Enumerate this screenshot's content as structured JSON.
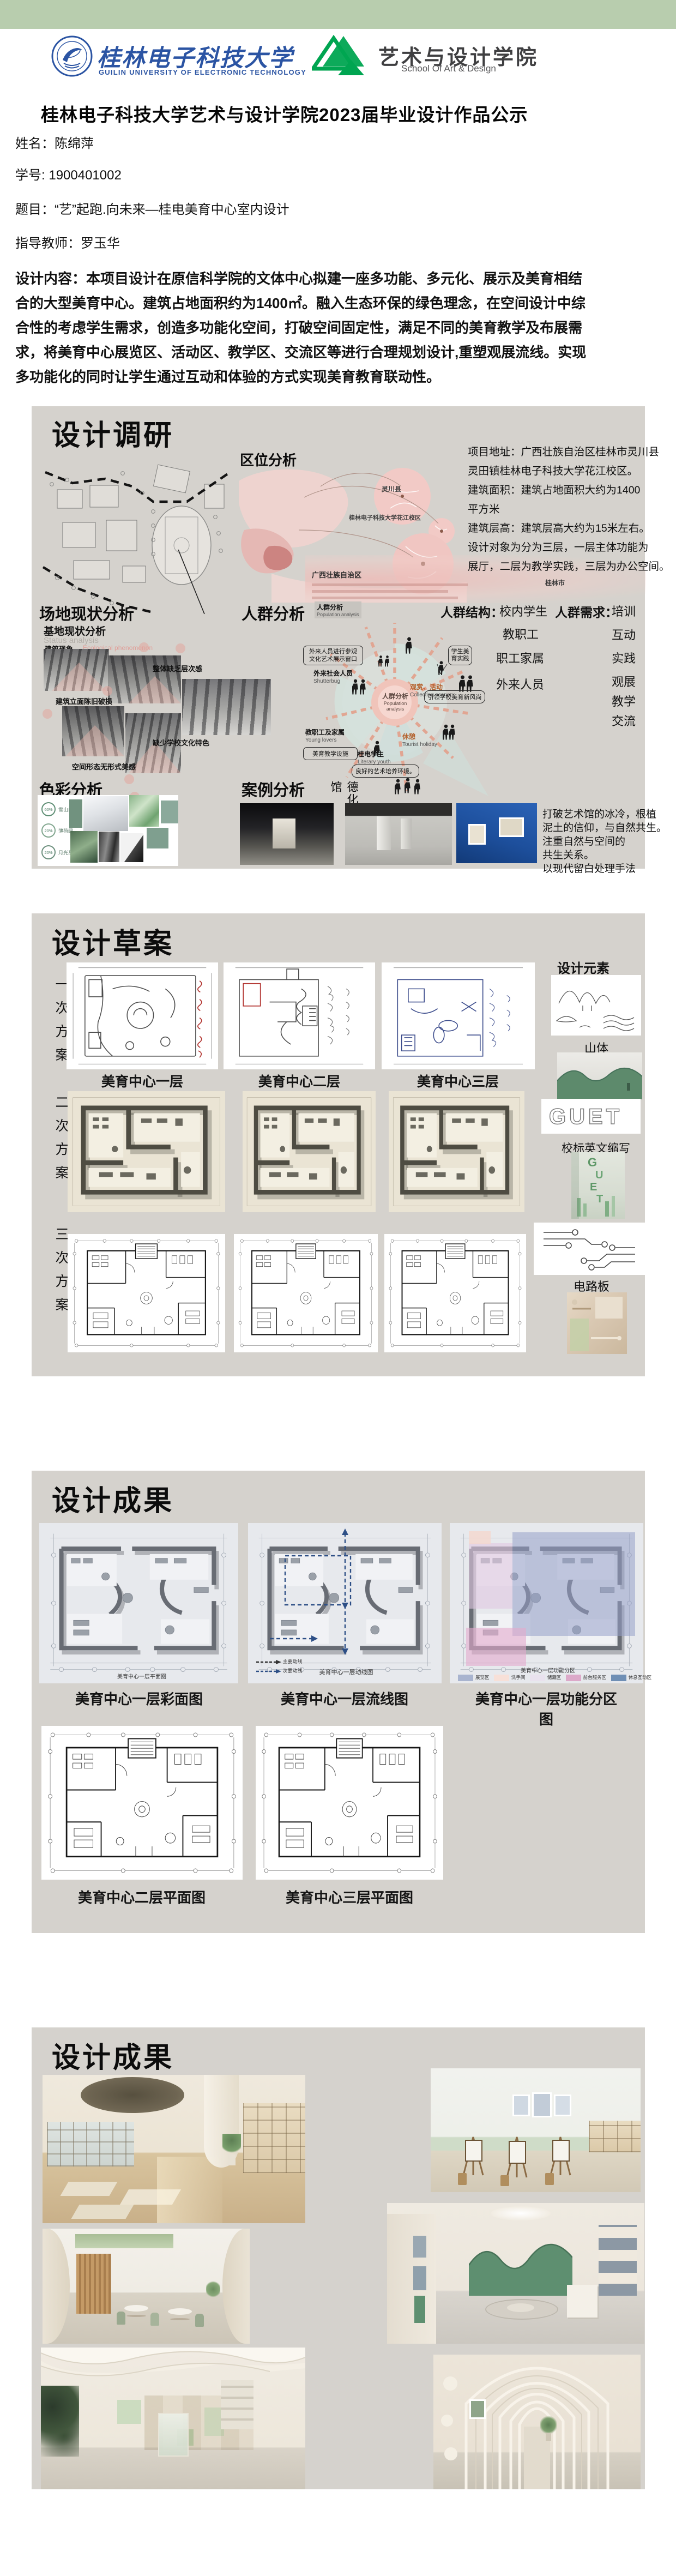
{
  "colors": {
    "top_bar_green": "#b8cdae",
    "panel_gray": "#d5d2cd",
    "guet_blue": "#2b54a3",
    "art_green": "#00a551",
    "map_pink": "#eecfcb",
    "ray_salmon": "#e2a38f",
    "sage_green": "#7f9f8f"
  },
  "header": {
    "guet_logo": {
      "zh": "桂林电子科技大学",
      "en": "GUILIN UNIVERSITY OF ELECTRONIC TECHNOLOGY"
    },
    "art_logo": {
      "zh": "艺术与设计学院",
      "en": "School Of Art & Design"
    }
  },
  "title": "桂林电子科技大学艺术与设计学院2023届毕业设计作品公示",
  "info": {
    "name_label": "姓名：",
    "name": "陈绵萍",
    "sid_label": "学号: ",
    "sid": "1900401002",
    "topic_label": "题目：",
    "topic": "“艺”起跑.向未来—桂电美育中心室内设计",
    "advisor_label": "指导教师：",
    "advisor": "罗玉华",
    "content_lines": [
      "设计内容：本项目设计在原信科学院的文体中心拟建一座多功能、多元化、展示及美育相结",
      "合的大型美育中心。建筑占地面积约为1400㎡。融入生态环保的绿色理念，在空间设计中综",
      "合性的考虑学生需求，创造多功能化空间，打破空间固定性，满足不同的美育教学及布展需",
      "求，将美育中心展览区、活动区、教学区、交流区等进行合理规划设计,重塑观展流线。实现",
      "多功能化的同时让学生通过互动和体验的方式实现美育教育联动性。"
    ]
  },
  "research": {
    "title": "设计调研",
    "location": {
      "heading": "区位分析",
      "labels": {
        "lingchuan": "灵川县",
        "campus": "桂林电子科技大学花江校区",
        "guilin": "桂林市",
        "guangxi": "广西壮族自治区"
      },
      "lines": [
        "项目地址：广西壮族自治区桂林市灵川县",
        "灵田镇桂林电子科技大学花江校区。",
        "建筑面积：建筑占地面积大约为1400",
        "平方米",
        "建筑层高：建筑层高大约为15米左右。",
        "设计对象为分为三层，一层主体功能为",
        "展厅，二层为教学实践，三层为办公空间。"
      ]
    },
    "site": {
      "heading": "场地现状分析",
      "sub": "基地现状分析",
      "sub_en": "Status analysis",
      "tag": "建筑现象",
      "tag_en": "Ecological phenomenon",
      "labels": [
        "整体缺乏层次感",
        "建筑立面陈旧破损",
        "缺少学校文化特色",
        "空间形态无形式美感"
      ]
    },
    "population": {
      "heading": "人群分析",
      "caption_zh": "人群分析",
      "caption_en": "Population analysis",
      "center_zh": "人群分析",
      "center_en1": "Population",
      "center_en2": "analysis",
      "bubbles": {
        "b1": "学生美育实践",
        "b2": "引领学校美育新风尚",
        "b3": "良好的艺术培养环境。",
        "b4": "美育教学设施",
        "b5a": "外来人员进行参观",
        "b5b": "文化艺术展示窗口"
      },
      "nodes": {
        "n1": "观赏、活动",
        "n1_en": "Collecting scenery",
        "n2": "休憩",
        "n2_en": "Tourist holiday",
        "n3": "桂电学生",
        "n3_en": "Literary youth",
        "n4": "教职工及家属",
        "n4_en": "Young lovers",
        "n5": "外来社会人员",
        "n5_en": "Shutterbug"
      },
      "structure_label": "人群结构：",
      "structure": [
        "校内学生",
        "教职工",
        "职工家属",
        "外来人员"
      ],
      "needs_label": "人群需求：",
      "needs": [
        "培训",
        "互动",
        "实践",
        "观展",
        "教学",
        "交流"
      ]
    },
    "color": {
      "heading": "色彩分析",
      "swatches": [
        {
          "pct": "60%",
          "name": "雪山白"
        },
        {
          "pct": "20%",
          "name": "薄荷绿"
        },
        {
          "pct": "20%",
          "name": "月光灰"
        }
      ]
    },
    "case": {
      "heading": "案例分析",
      "name": "德化龙鹏艺术馆",
      "desc": [
        "打破艺术馆的冰冷，根植",
        "泥土的信仰，与自然共生。",
        "注重自然与空间的",
        "共生关系。",
        "以现代留白处理手法"
      ]
    }
  },
  "draft": {
    "title": "设计草案",
    "schemes": [
      "一次方案",
      "二次方案",
      "三次方案"
    ],
    "captions": [
      "美育中心一层",
      "美育中心二层",
      "美育中心三层"
    ],
    "elements": {
      "heading": "设计元素",
      "item1": "山体",
      "item2": "校标英文缩写",
      "item3": "电路板",
      "guet": "GUET"
    }
  },
  "results_plans": {
    "title": "设计成果",
    "row1_captions": [
      "美育中心一层彩面图",
      "美育中心一层流线图",
      "美育中心一层功能分区图"
    ],
    "row1_inner_titles": [
      "美育中心一层平面图",
      "美育中心一层动线图",
      "美育中心一层功能分区"
    ],
    "flow_legend": [
      "主要动线",
      "次要动线"
    ],
    "zones": [
      {
        "name": "展览区",
        "color": "#a9b4cf"
      },
      {
        "name": "洗手间",
        "color": "#f7e0d8"
      },
      {
        "name": "储藏区",
        "color": "#e9e2ee"
      },
      {
        "name": "前台服务区",
        "color": "#dca9c9"
      },
      {
        "name": "休息互动区",
        "color": "#6f8fb5"
      }
    ],
    "row2_captions": [
      "美育中心二层平面图",
      "美育中心三层平面图"
    ]
  },
  "results_renders": {
    "title": "设计成果"
  }
}
